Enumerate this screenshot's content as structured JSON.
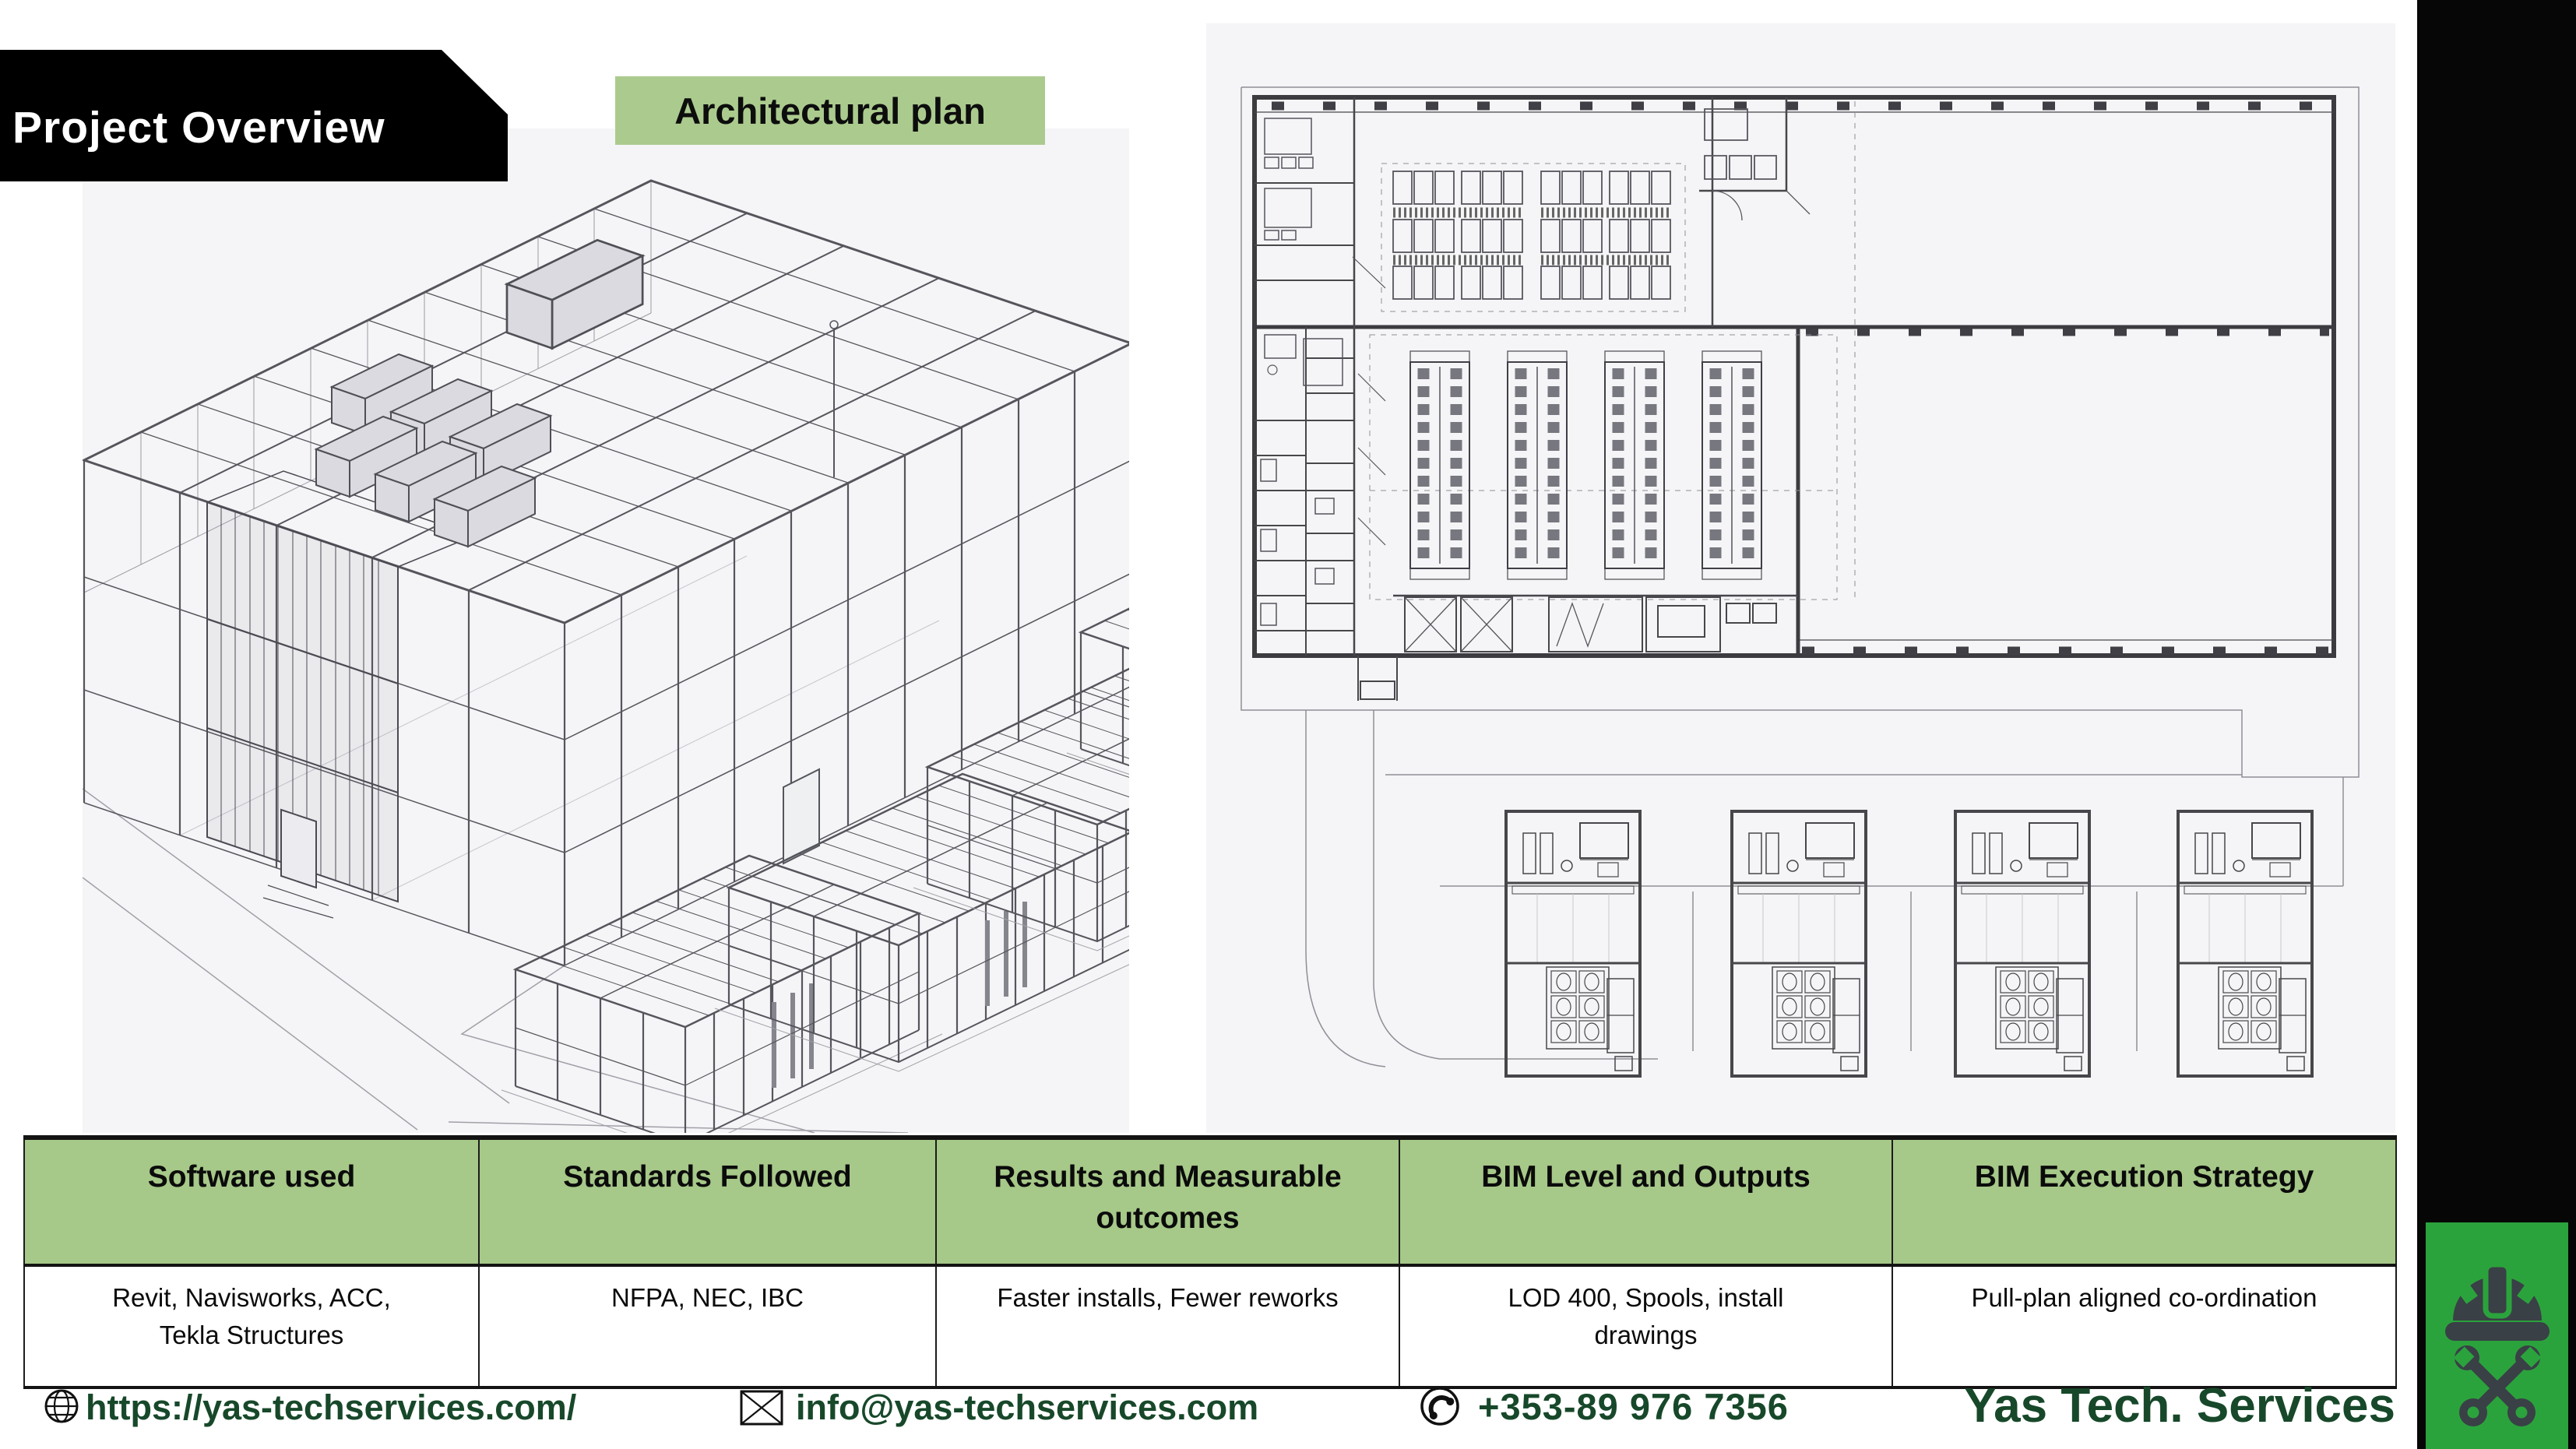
{
  "slide": {
    "title": "Project Overview",
    "image_label": "Architectural plan"
  },
  "table": {
    "headers": [
      "Software used",
      "Standards Followed",
      "Results and Measurable\noutcomes",
      "BIM Level and Outputs",
      "BIM Execution Strategy"
    ],
    "rows": [
      [
        "Revit, Navisworks, ACC,\nTekla Structures",
        "NFPA, NEC, IBC",
        "Faster installs, Fewer reworks",
        "LOD 400, Spools, install\ndrawings",
        "Pull-plan aligned co-ordination"
      ]
    ]
  },
  "footer": {
    "website": "https://yas-techservices.com/",
    "email": "info@yas-techservices.com",
    "phone": "+353-89 976 7356",
    "company": "Yas Tech. Services",
    "icons": {
      "website_icon": "globe-icon",
      "email_icon": "envelope-icon",
      "phone_icon": "phone-circle-icon",
      "logo_icon": "hardhat-crossed-wrenches-icon"
    }
  },
  "colors": {
    "banner_black": "#000000",
    "label_green": "#abcb8e",
    "table_header_green": "#a6c888",
    "footer_text_green": "#17482a",
    "logo_green": "#2ba33c",
    "sidebar_black": "#060606",
    "drawing_background": "#f5f5f7"
  }
}
